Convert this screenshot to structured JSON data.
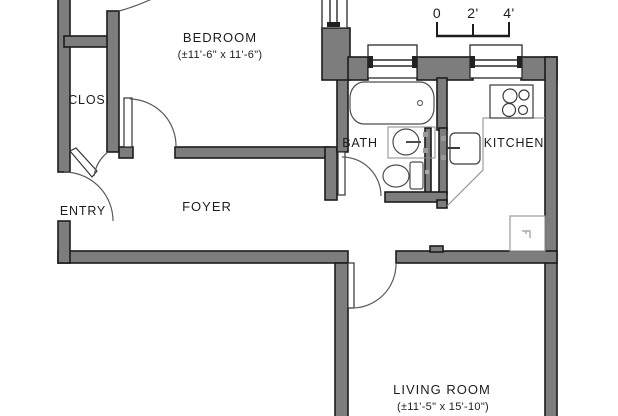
{
  "plan": {
    "title": "apartment-floor-plan",
    "scale_bar": {
      "ticks": [
        "0",
        "2'",
        "4'"
      ]
    },
    "rooms": {
      "bedroom": {
        "label": "BEDROOM",
        "dims": "(±11'-6\" x 11'-6\")"
      },
      "closet": {
        "label": "CLOS."
      },
      "entry": {
        "label": "ENTRY"
      },
      "foyer": {
        "label": "FOYER"
      },
      "bath": {
        "label": "BATH"
      },
      "kitchen": {
        "label": "KITCHEN"
      },
      "living_room": {
        "label": "LIVING ROOM",
        "dims": "(±11'-5\" x 15'-10\")"
      }
    },
    "fixtures": [
      "bathtub",
      "bathroom-sink",
      "toilet",
      "stove",
      "kitchen-sink",
      "kitchen-counter",
      "refrigerator"
    ],
    "colors": {
      "wall_fill": "#7d7d7d",
      "wall_outline": "#1c1c1c",
      "fixture_line": "#4d4d4d",
      "light_line": "#8a8a8a",
      "background": "#ffffff"
    }
  }
}
